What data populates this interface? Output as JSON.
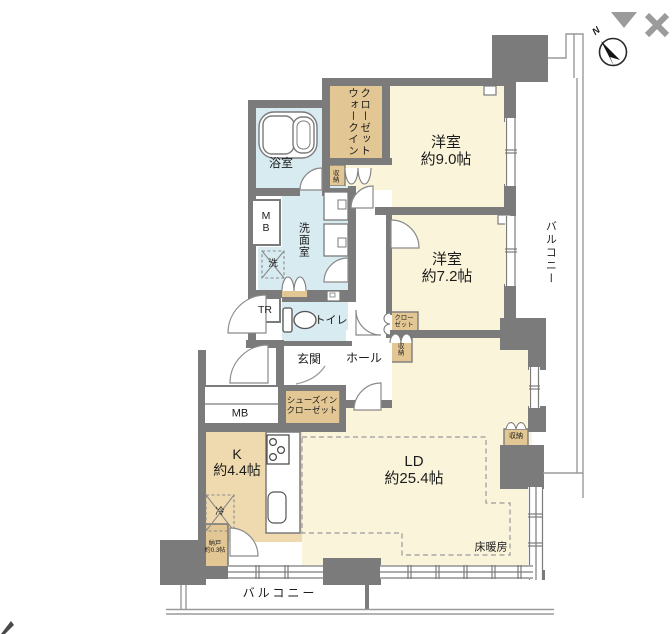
{
  "compass": {
    "north_label": "N"
  },
  "rooms": {
    "western9": {
      "name": "洋室",
      "area": "約9.0帖"
    },
    "western7": {
      "name": "洋室",
      "area": "約7.2帖"
    },
    "living_dining": {
      "name": "LD",
      "area": "約25.4帖"
    },
    "kitchen": {
      "name": "K",
      "area": "約4.4帖"
    },
    "storeroom": {
      "name": "納戸",
      "area": "約0.3帖"
    },
    "walk_in_closet": {
      "line1": "ウォークイン",
      "line2": "クローゼット"
    },
    "shoes_in_closet": {
      "line1": "シューズイン",
      "line2": "クローゼット"
    },
    "closet": {
      "line1": "クロー",
      "line2": "ゼット"
    }
  },
  "labels": {
    "balcony": "バルコニー",
    "floor_heating": "床暖房",
    "storage": "収納",
    "mb": "MB",
    "tr": "TR",
    "washer": "洗",
    "fridge": "冷",
    "bathroom": "浴室",
    "washroom": "洗面室",
    "toilet": "トイレ",
    "entrance": "玄関",
    "hall": "ホール"
  },
  "colors": {
    "wall": "#7b7b7b",
    "room_floor": "#FAF4DA",
    "kitchen_floor": "#EFD9AF",
    "closet_floor": "#E2C693",
    "wet_area_floor": "#D8EBF1",
    "ui_control_gray": "#9b9b9b",
    "line_gray": "#9a9a9a"
  }
}
